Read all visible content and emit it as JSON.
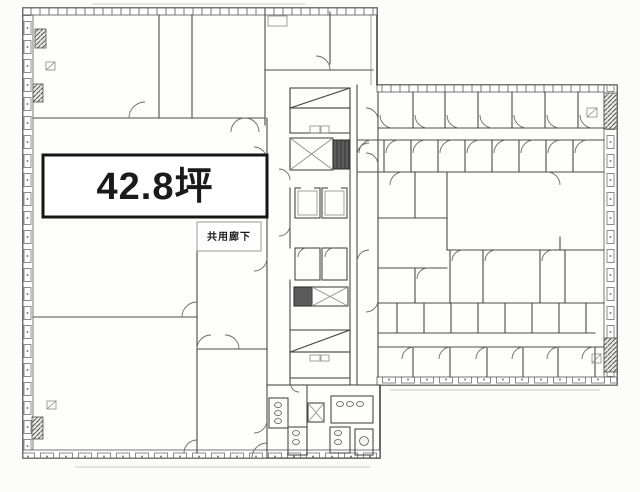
{
  "plan": {
    "area_label": "42.8坪",
    "corridor_label": "共用廊下",
    "colors": {
      "background": "#fcfcfb",
      "wall_line": "#4a4a4a",
      "light_line": "#8a8a8a",
      "highlight_border": "#151515",
      "highlight_fill": "#ffffff",
      "shaft_fill": "#5c5c5c",
      "label_text": "#1a1a1a"
    },
    "icons": {
      "stairs": "vertical-hatch-block",
      "elevator_shaft": "x-crossed-box",
      "elevator_car": "nested-rect",
      "window": "crossed-square",
      "toilet_stall": "oval-fixture"
    }
  }
}
